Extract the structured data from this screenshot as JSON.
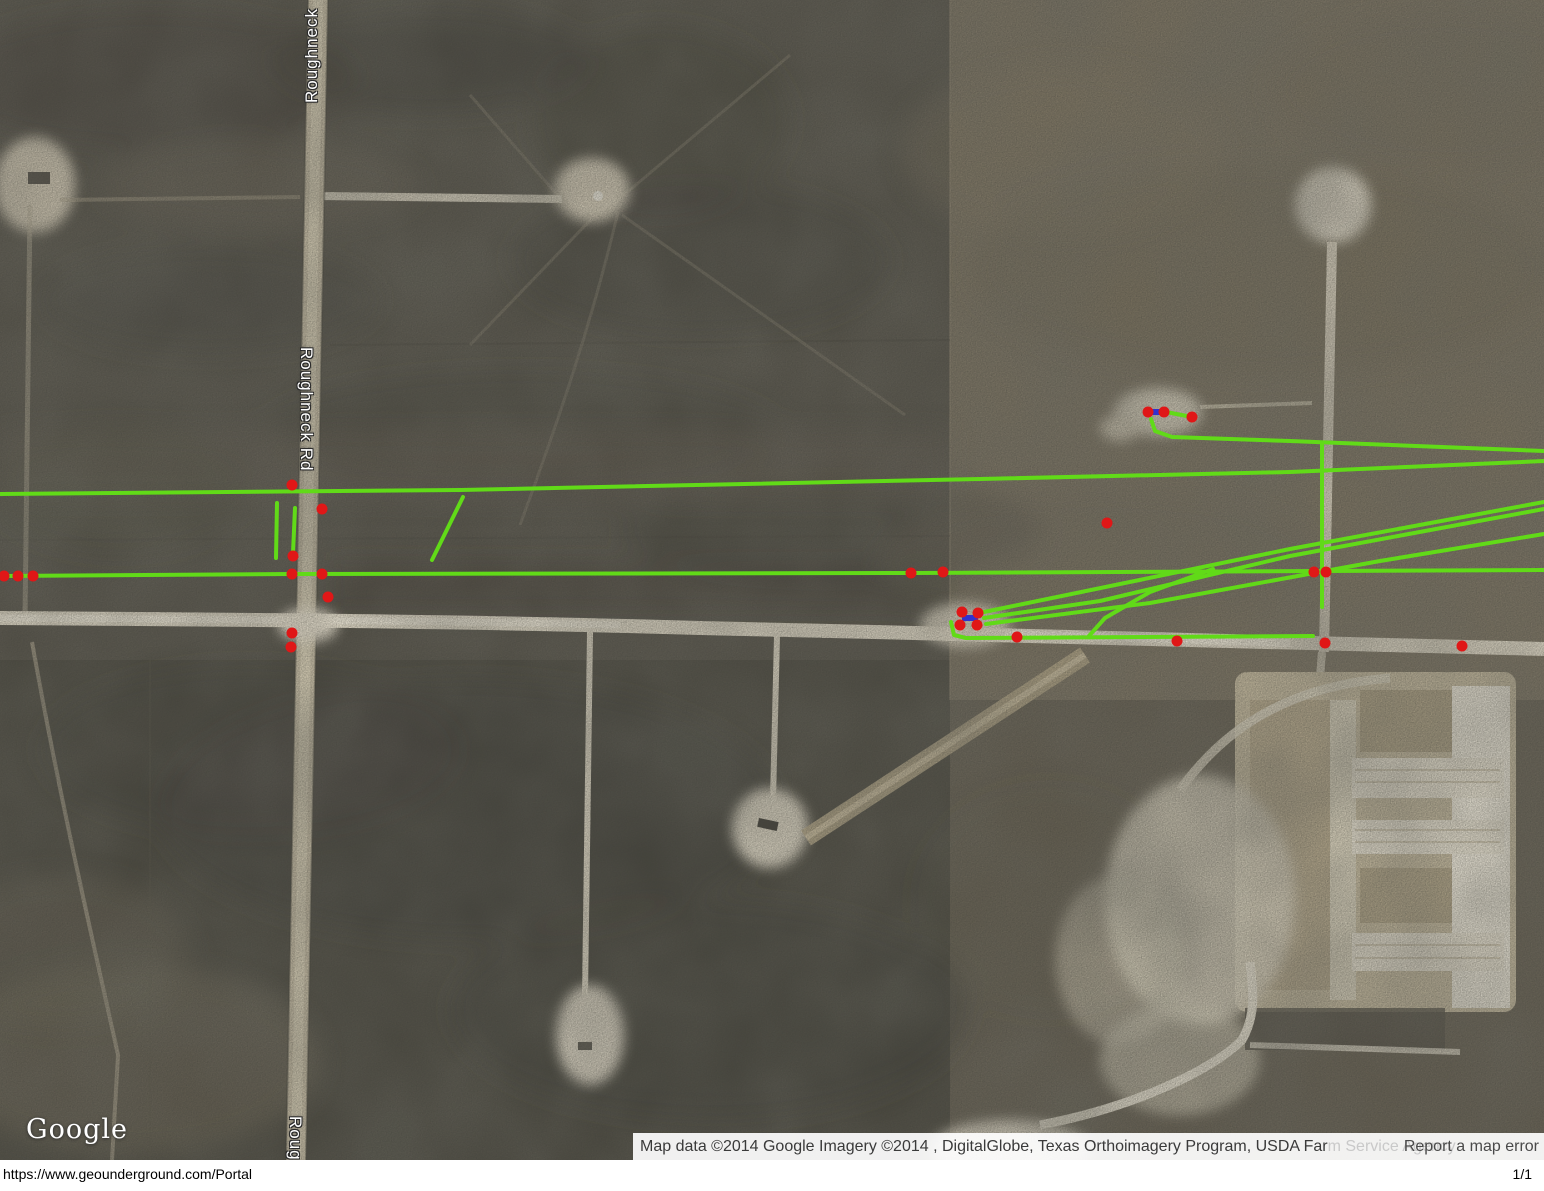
{
  "map": {
    "road_labels": [
      {
        "text": "Roughneck"
      },
      {
        "text": "Roughneck Rd"
      },
      {
        "text": "Roughneck Rd"
      }
    ],
    "logo_text": "Google",
    "attribution": {
      "head": "Map data ©2014 Google Imagery ©2014 , DigitalGlobe, Texas Orthoimagery Program, USDA Far",
      "tail": "m Service Agency",
      "report_link": "Report a map error"
    },
    "overlay": {
      "colors": {
        "line": "#61da18",
        "marker": "#e01717",
        "tie": "#3032cf"
      },
      "polylines": [
        {
          "name": "pipeline-upper-long",
          "points": [
            [
              0,
              494
            ],
            [
              460,
              490
            ],
            [
              980,
              479
            ],
            [
              1290,
              472
            ],
            [
              1544,
              461
            ]
          ]
        },
        {
          "name": "pipeline-lower-long",
          "points": [
            [
              0,
              576
            ],
            [
              292,
              574
            ],
            [
              911,
              573
            ],
            [
              1326,
              571
            ],
            [
              1544,
              570
            ]
          ]
        },
        {
          "name": "pipeline-ne-lateral",
          "points": [
            [
              1151,
              419
            ],
            [
              1155,
              431
            ],
            [
              1172,
              437
            ],
            [
              1290,
              441
            ],
            [
              1544,
              451
            ]
          ]
        },
        {
          "name": "pipeline-right-vertical",
          "points": [
            [
              1322,
              443
            ],
            [
              1322,
              607
            ]
          ]
        },
        {
          "name": "pipeline-bundle-a",
          "points": [
            [
              984,
              612
            ],
            [
              1290,
              549
            ],
            [
              1544,
              502
            ]
          ]
        },
        {
          "name": "pipeline-bundle-b",
          "points": [
            [
              984,
              618
            ],
            [
              1100,
              601
            ],
            [
              1290,
              556
            ],
            [
              1544,
              509
            ]
          ]
        },
        {
          "name": "pipeline-bundle-c",
          "points": [
            [
              986,
              624
            ],
            [
              1150,
              603
            ],
            [
              1380,
              561
            ],
            [
              1544,
              534
            ]
          ]
        },
        {
          "name": "pipeline-branch-curve",
          "points": [
            [
              1213,
              569
            ],
            [
              1150,
              592
            ],
            [
              1105,
              618
            ],
            [
              1089,
              636
            ]
          ]
        },
        {
          "name": "pipeline-pad-lateral",
          "points": [
            [
              951,
              622
            ],
            [
              954,
              635
            ],
            [
              966,
              638
            ],
            [
              1313,
              636
            ]
          ]
        },
        {
          "name": "pipeline-ne-pad-tie",
          "points": [
            [
              1166,
              412
            ],
            [
              1192,
              417
            ]
          ]
        },
        {
          "name": "pipeline-stub-left-a",
          "points": [
            [
              277,
              503
            ],
            [
              276,
              558
            ]
          ]
        },
        {
          "name": "pipeline-stub-left-b",
          "points": [
            [
              295,
              508
            ],
            [
              293,
              553
            ]
          ]
        },
        {
          "name": "pipeline-stub-diagonal",
          "points": [
            [
              463,
              497
            ],
            [
              432,
              560
            ]
          ]
        }
      ],
      "ties": [
        {
          "name": "tie-ne-pad",
          "points": [
            [
              1149,
              412
            ],
            [
              1164,
              412
            ]
          ]
        },
        {
          "name": "tie-mid-pad",
          "points": [
            [
              962,
              618
            ],
            [
              978,
              618
            ]
          ]
        }
      ],
      "markers": [
        [
          4,
          576
        ],
        [
          18,
          576
        ],
        [
          33,
          576
        ],
        [
          292,
          485
        ],
        [
          322,
          509
        ],
        [
          293,
          556
        ],
        [
          292,
          574
        ],
        [
          322,
          574
        ],
        [
          328,
          597
        ],
        [
          292,
          633
        ],
        [
          291,
          647
        ],
        [
          911,
          573
        ],
        [
          943,
          572
        ],
        [
          962,
          612
        ],
        [
          978,
          613
        ],
        [
          960,
          625
        ],
        [
          977,
          625
        ],
        [
          1017,
          637
        ],
        [
          1177,
          641
        ],
        [
          1107,
          523
        ],
        [
          1148,
          412
        ],
        [
          1164,
          412
        ],
        [
          1192,
          417
        ],
        [
          1314,
          572
        ],
        [
          1326,
          572
        ],
        [
          1325,
          643
        ],
        [
          1462,
          646
        ]
      ]
    }
  },
  "footer": {
    "url": "https://www.geounderground.com/Portal",
    "page_indicator": "1/1"
  }
}
